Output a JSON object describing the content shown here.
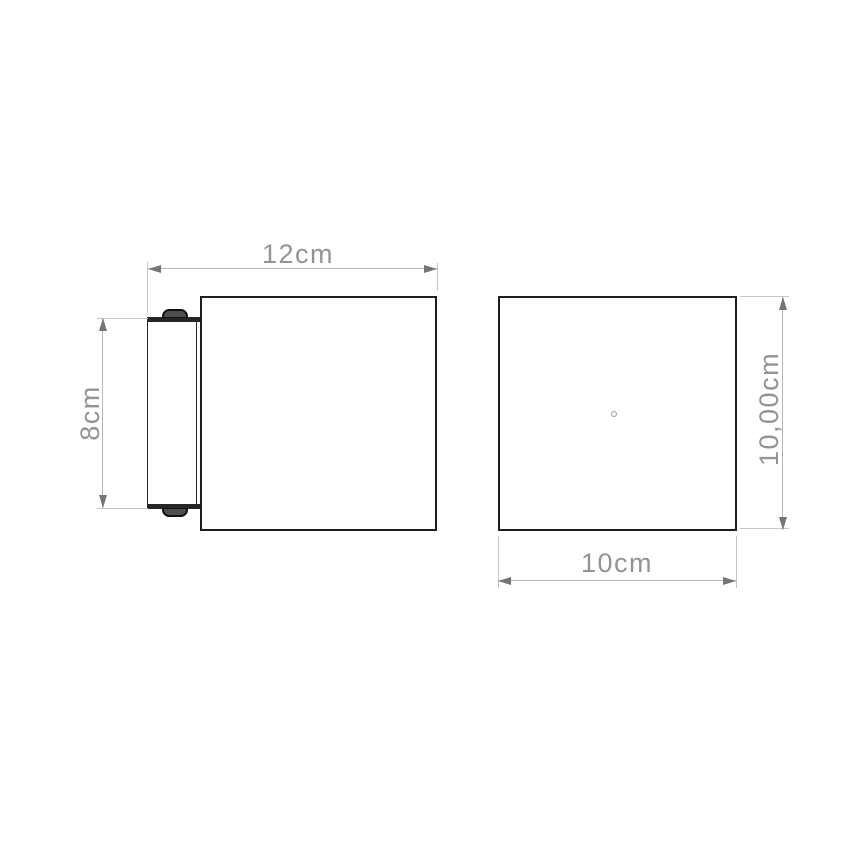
{
  "dimensions": {
    "depth": {
      "label": "12cm"
    },
    "bracket_height": {
      "label": "8cm"
    },
    "front_width": {
      "label": "10cm"
    },
    "front_height": {
      "label": "10,00cm"
    }
  },
  "colors": {
    "body_outline": "#1f1f1f",
    "bracket_fill": "#262626",
    "screw_fill": "#4f4f4f",
    "dimension_line": "#b5b5b5",
    "extension_line": "#c6c6c6",
    "arrowhead": "#757575",
    "dimension_text": "#949494",
    "background": "#ffffff"
  }
}
